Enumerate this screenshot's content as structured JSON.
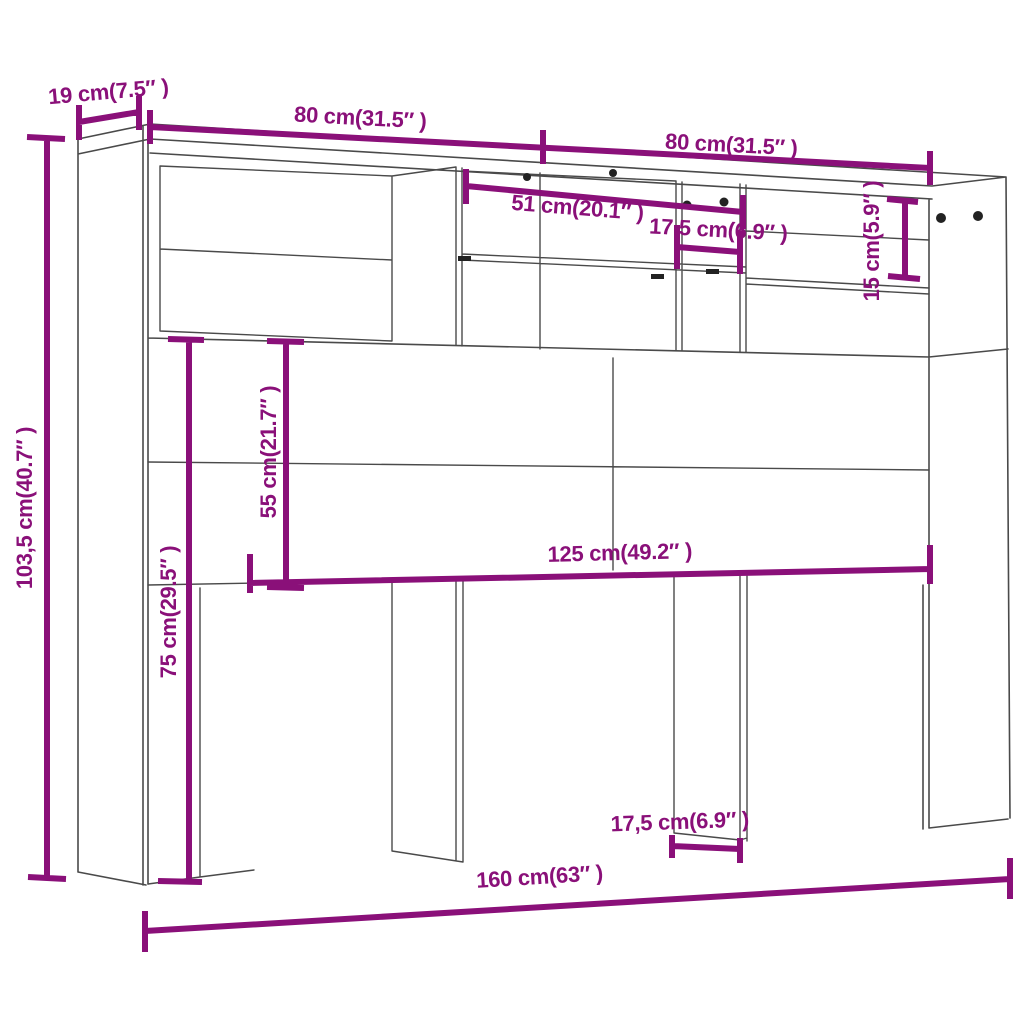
{
  "diagram": {
    "type": "furniture-dimension-diagram",
    "subject": "headboard-cabinet-line-drawing",
    "accent_color": "#8a1079",
    "line_color": "#4a4a4a",
    "dot_color": "#222222",
    "dimensions": {
      "depth": "19 cm(7.5″ )",
      "width_left_half": "80 cm(31.5″ )",
      "width_right_half": "80 cm(31.5″ )",
      "shelf_width": "51 cm(20.1″ )",
      "cubby_width": "17,5 cm(6.9″ )",
      "top_slot_height": "15 cm(5.9″ )",
      "total_height": "103,5 cm(40.7″ )",
      "panel_height": "55 cm(21.7″ )",
      "leg_height": "75 cm(29.5″ )",
      "inner_width": "125 cm(49.2″ )",
      "leg_width": "17,5 cm(6.9″ )",
      "total_width": "160 cm(63″ )"
    }
  }
}
